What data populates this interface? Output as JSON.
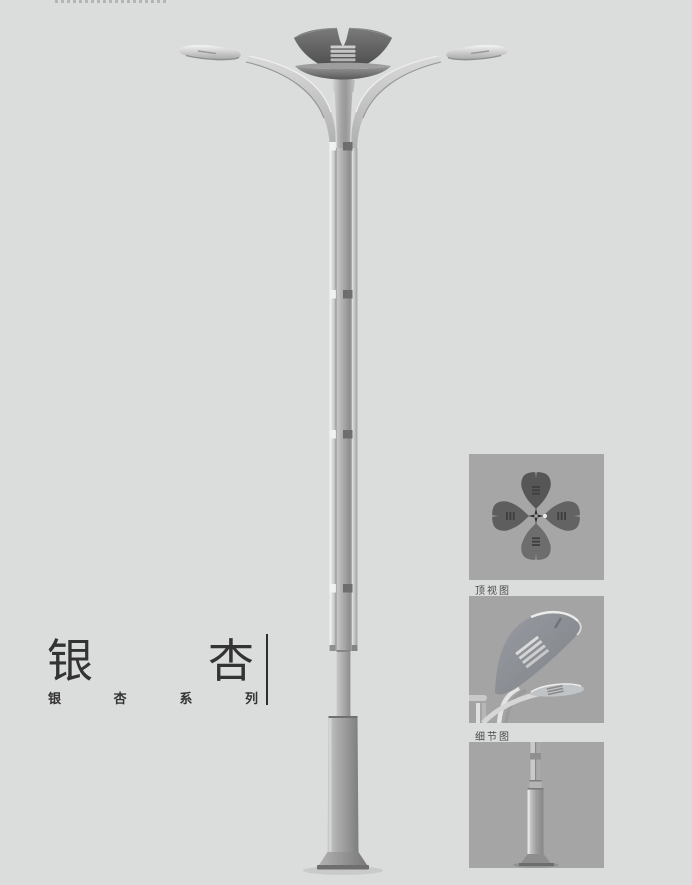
{
  "page": {
    "background_color": "#dbdcdc"
  },
  "title_block": {
    "title": "银杏",
    "title_chars": [
      "银",
      "杏"
    ],
    "subtitle": "银杏系列",
    "subtitle_chars": [
      "银",
      "杏",
      "系",
      "列"
    ],
    "text_color": "#333333",
    "divider_color": "#2e2e2e"
  },
  "thumbnails": {
    "background_color": "#a6a6a6",
    "caption_color": "#4a4a4a",
    "items": [
      {
        "id": "top-view",
        "caption": "顶视图"
      },
      {
        "id": "detail-view",
        "caption": "细节图"
      },
      {
        "id": "base-view",
        "caption": ""
      }
    ]
  },
  "illustration": {
    "subject": "ginkgo-double-arm-street-lamp",
    "metal_light": "#f2f2f2",
    "metal_mid": "#b5b5b5",
    "metal_dark": "#8a8a8a",
    "crown_color": "#565656"
  }
}
